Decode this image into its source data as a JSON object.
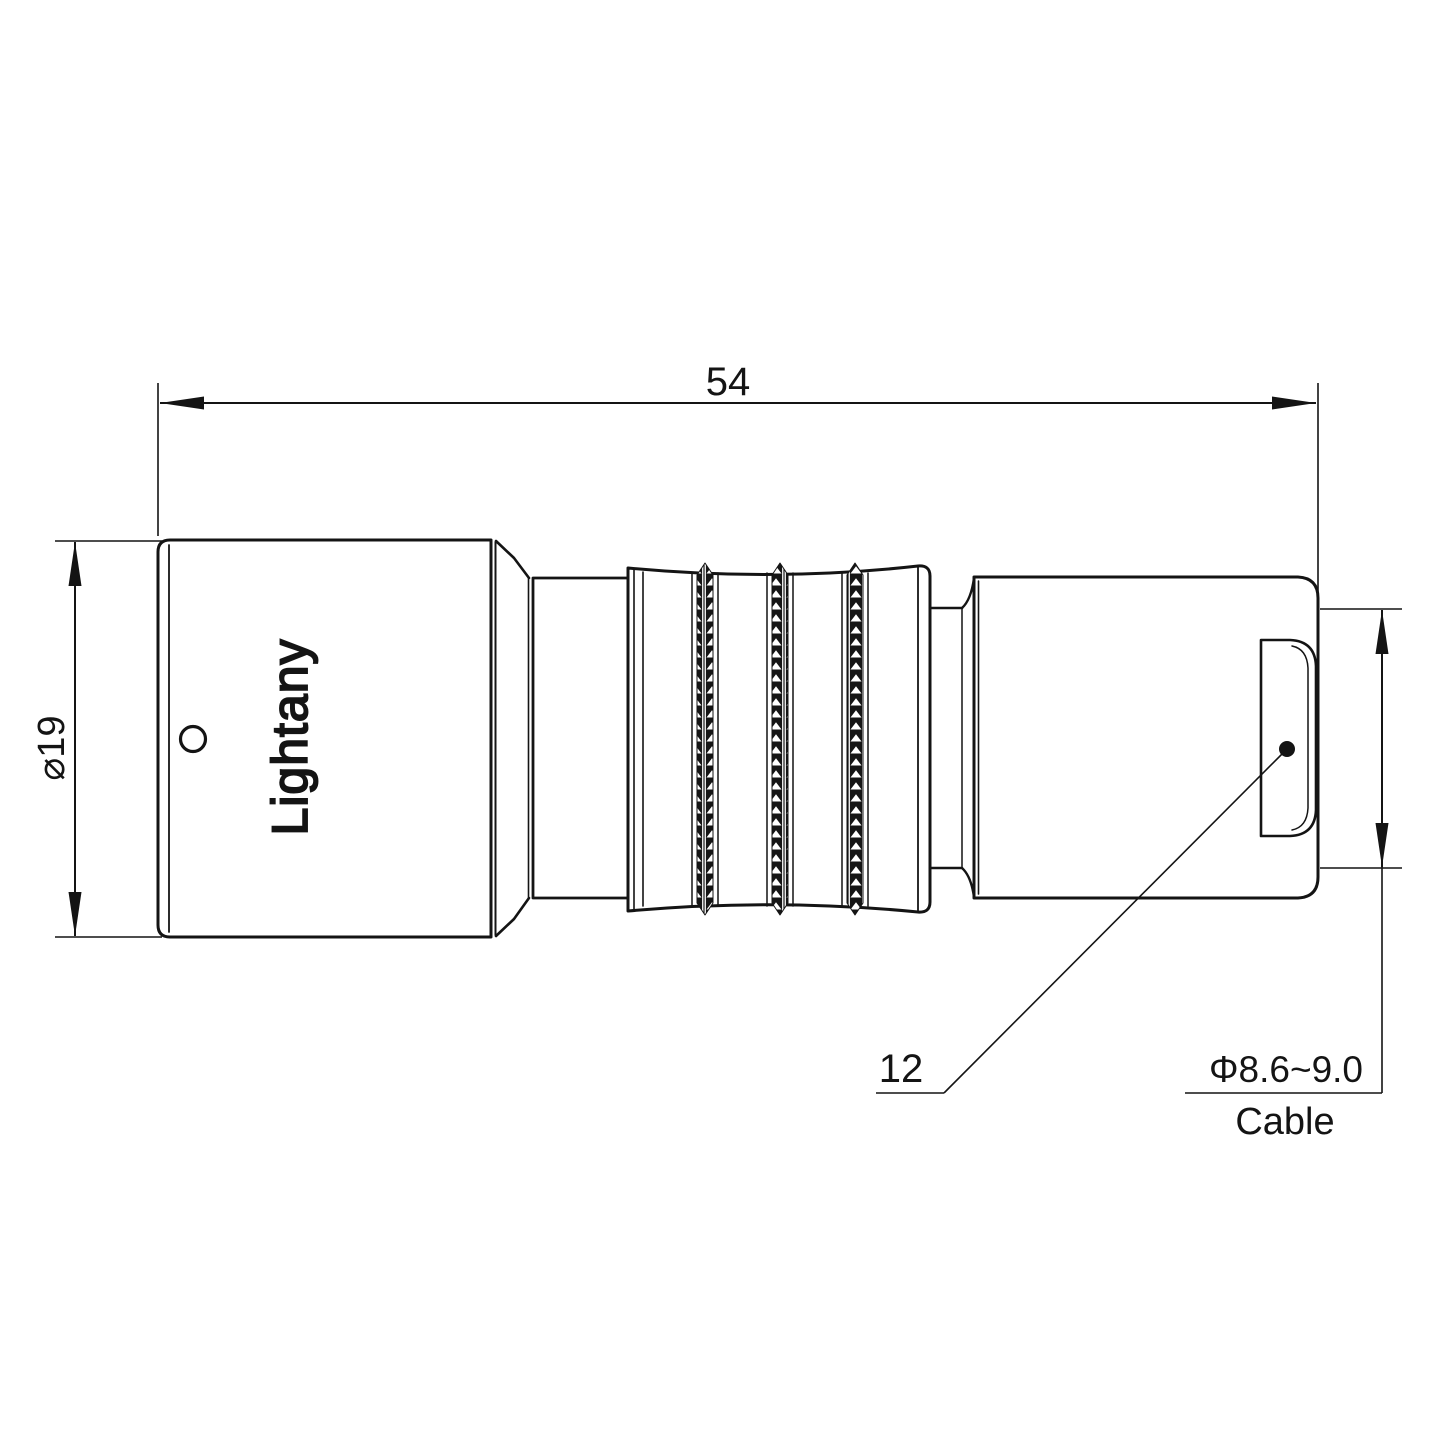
{
  "drawing": {
    "dim_length": "54",
    "dim_diameter": "⌀19",
    "dim_rear_width": "12",
    "dim_cable_range": "Φ8.6~9.0",
    "dim_cable_label": "Cable",
    "body_engraving": "Lightany",
    "watermark_text": "Lightany",
    "colors": {
      "line": "#141414",
      "watermark": "#eeb0b0",
      "background": "#ffffff"
    }
  }
}
